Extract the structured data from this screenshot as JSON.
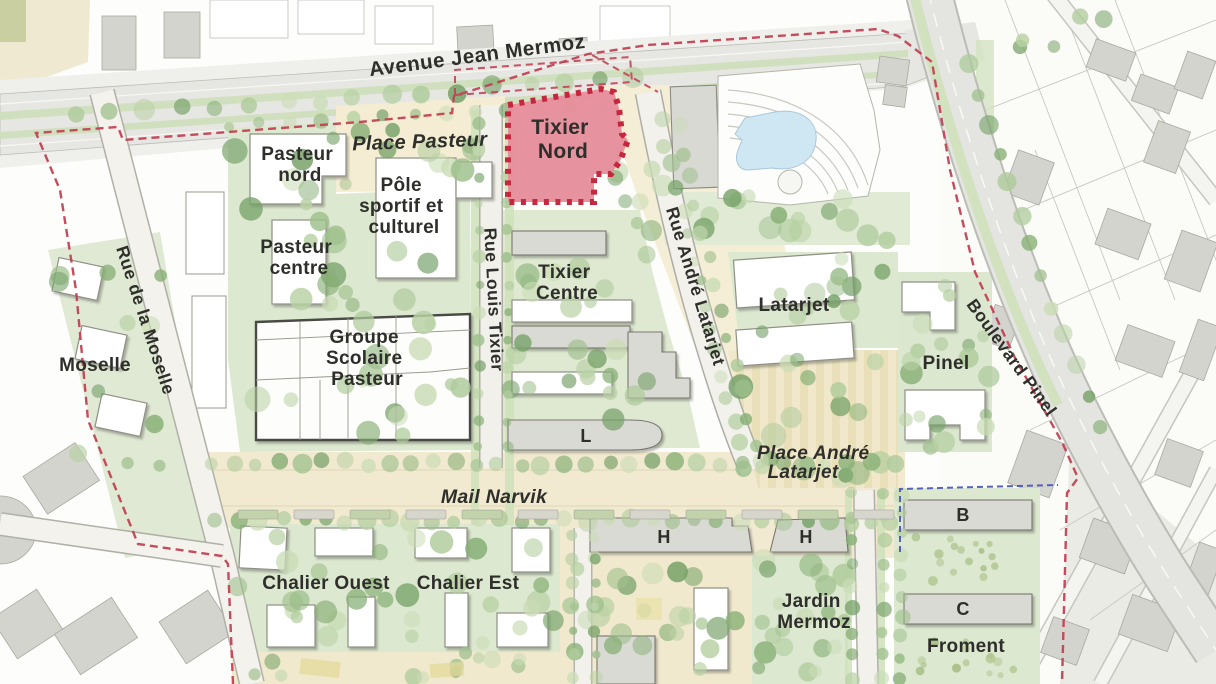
{
  "map": {
    "streets": {
      "avenue_jean_mermoz": "Avenue Jean Mermoz",
      "rue_de_la_moselle": "Rue de la Moselle",
      "rue_louis_tixier": "Rue Louis Tixier",
      "rue_andre_latarjet": "Rue André Latarjet",
      "boulevard_pinel": "Boulevard Pinel",
      "mail_narvik": "Mail Narvik"
    },
    "places": {
      "place_pasteur": "Place Pasteur",
      "place_andre_latarjet": [
        "Place André",
        "Latarjet"
      ],
      "jardin_mermoz": [
        "Jardin",
        "Mermoz"
      ]
    },
    "sectors": {
      "pasteur_nord": [
        "Pasteur",
        "nord"
      ],
      "pasteur_centre": [
        "Pasteur",
        "centre"
      ],
      "pole_sportif_culturel": [
        "Pôle",
        "sportif et",
        "culturel"
      ],
      "groupe_scolaire_pasteur": [
        "Groupe",
        "Scolaire",
        "Pasteur"
      ],
      "moselle": "Moselle",
      "tixier_centre": [
        "Tixier",
        "Centre"
      ],
      "latarjet": "Latarjet",
      "pinel": "Pinel",
      "chalier_ouest": "Chalier Ouest",
      "chalier_est": "Chalier Est",
      "froment": "Froment"
    },
    "highlight": {
      "label": [
        "Tixier",
        "Nord"
      ],
      "fill": "#E78F9C",
      "border": "#C42239"
    },
    "building_labels": {
      "l": "L",
      "h_west": "H",
      "h_east": "H",
      "b": "B",
      "c": "C"
    },
    "legend_colors": {
      "project_boundary": "#C24254",
      "phase_boundary_blue": "#4553B8",
      "green_space": "#DCE8CF",
      "plaza": "#F2EAD0",
      "road": "#E6E6E2",
      "building_white": "#FFFFFF",
      "building_grey": "#DCDCD6",
      "water": "#CFE7F3"
    }
  }
}
